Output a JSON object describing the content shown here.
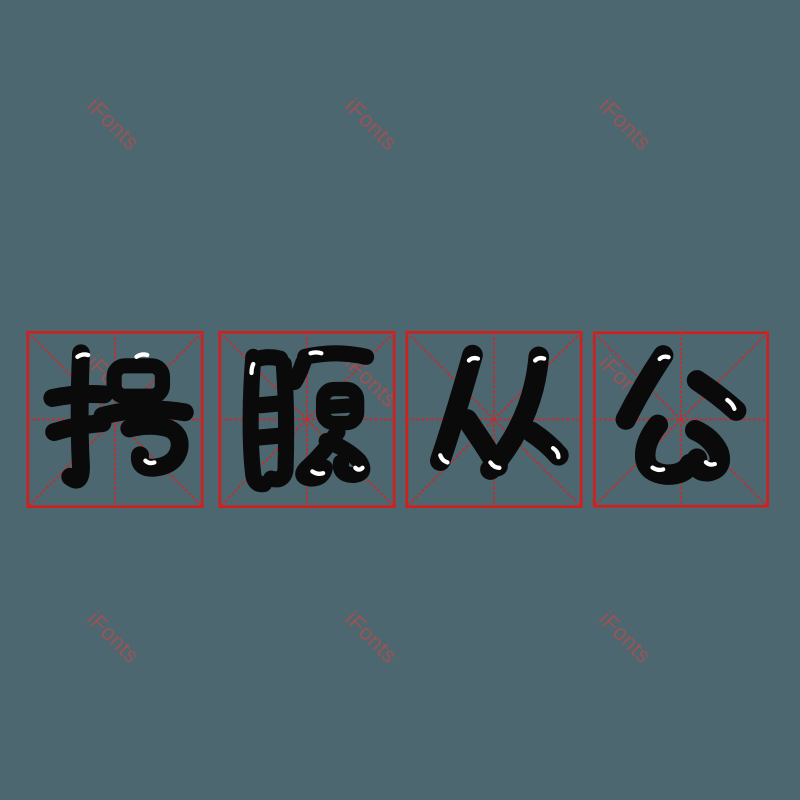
{
  "app": {
    "brand": "iFonts"
  },
  "background_color": "#4c676f",
  "watermark": {
    "text": "iFonts",
    "color": "#9f5353",
    "rotation_deg": 45,
    "font_size_px": 22,
    "positions": [
      {
        "x": 100,
        "y": 93
      },
      {
        "x": 358,
        "y": 93
      },
      {
        "x": 612,
        "y": 93
      },
      {
        "x": 100,
        "y": 350
      },
      {
        "x": 358,
        "y": 350
      },
      {
        "x": 612,
        "y": 350
      },
      {
        "x": 100,
        "y": 606
      },
      {
        "x": 358,
        "y": 606
      },
      {
        "x": 612,
        "y": 606
      }
    ]
  },
  "idiom": {
    "text": "枵腹从公",
    "characters": [
      "枵",
      "腹",
      "从",
      "公"
    ],
    "glyph_color": "#0a0a0a",
    "style": "rounded bubble handwriting font"
  },
  "grid": {
    "type": "mi-zi-ge rice grid",
    "count": 4,
    "border_color": "#cf2020",
    "dash_color": "#d42626"
  }
}
